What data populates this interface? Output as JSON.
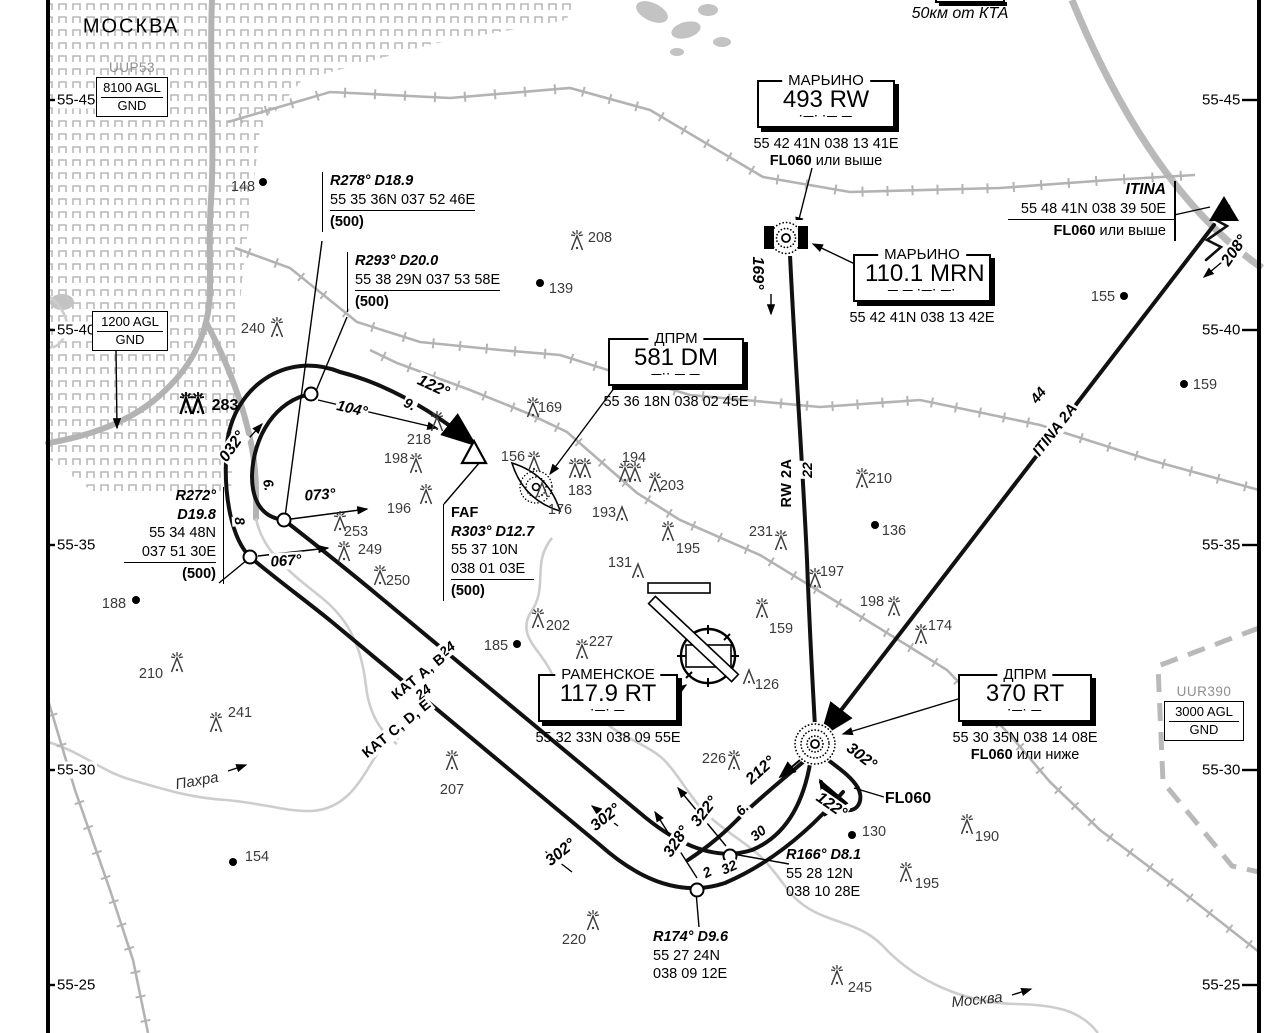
{
  "map": {
    "city_label": "МОСКВА",
    "scale_note": "50км от КТА",
    "lat_labels": [
      {
        "t": "55-45",
        "y": 100
      },
      {
        "t": "55-40",
        "y": 330
      },
      {
        "t": "55-35",
        "y": 545
      },
      {
        "t": "55-30",
        "y": 770
      },
      {
        "t": "55-25",
        "y": 985
      }
    ],
    "airspace_boxes": [
      {
        "id": "uup53",
        "title": "UUP53",
        "rows": [
          "8100 AGL",
          "GND"
        ],
        "x": 96,
        "y": 60,
        "w": 72
      },
      {
        "id": "agl1200",
        "title": "",
        "rows": [
          "1200 AGL",
          "GND"
        ],
        "x": 92,
        "y": 311,
        "w": 76
      },
      {
        "id": "uur390",
        "title": "UUR390",
        "rows": [
          "3000 AGL",
          "GND"
        ],
        "x": 1164,
        "y": 684,
        "w": 80
      }
    ],
    "navaid_boxes": [
      {
        "id": "marino-rw",
        "title": "МАРЬИНО",
        "ident": "493 RW",
        "morse": "·—·   ·— —",
        "x": 757,
        "y": 80,
        "w": 134,
        "coords": "55 42 41N 038 13 41E",
        "note": "FL060 или выше"
      },
      {
        "id": "marino-mrn",
        "title": "МАРЬИНО",
        "ident": "110.1 MRN",
        "morse": "— —   ·—·   —·",
        "x": 853,
        "y": 254,
        "w": 134,
        "coords": "55 42 41N 038 13 42E"
      },
      {
        "id": "dprm-dm",
        "title": "ДПРМ",
        "ident": "581 DM",
        "morse": "—··   — —",
        "x": 608,
        "y": 338,
        "w": 132,
        "coords": "55 36 18N 038 02 45E"
      },
      {
        "id": "ramenskoe",
        "title": "РАМЕНСКОЕ",
        "ident": "117.9 RT",
        "morse": "·—·   —",
        "x": 538,
        "y": 674,
        "w": 136,
        "coords": "55 32 33N 038 09 55E"
      },
      {
        "id": "dprm-rt",
        "title": "ДПРМ",
        "ident": "370 RT",
        "morse": "·—·   —",
        "x": 958,
        "y": 674,
        "w": 130,
        "coords": "55 30 35N 038 14 08E",
        "note": "FL060 или ниже"
      }
    ],
    "itina_box": {
      "title": "ITINA",
      "coords": "55 48 41N 038 39 50E",
      "note": "FL060 или выше",
      "x": 1008,
      "y": 181,
      "w": 166
    },
    "fix_blocks": [
      {
        "id": "r278",
        "bar": "left",
        "x": 322,
        "y": 172,
        "lines": [
          [
            "R278° D18.9",
            "bi"
          ],
          [
            "55 35 36N 037 52 46E",
            "n ul"
          ]
        ],
        "tail": "(500)"
      },
      {
        "id": "r293",
        "bar": "left",
        "x": 347,
        "y": 252,
        "lines": [
          [
            "R293° D20.0",
            "bi"
          ],
          [
            "55 38 29N 037 53 58E",
            "n ul"
          ]
        ],
        "tail": "(500)"
      },
      {
        "id": "r272",
        "bar": "right",
        "x": 124,
        "y": 487,
        "w": 92,
        "lines": [
          [
            "R272°",
            "bi"
          ],
          [
            "D19.8",
            "bi"
          ],
          [
            "55 34 48N",
            "n"
          ],
          [
            "037 51 30E",
            "n ul"
          ]
        ],
        "tail": "(500)"
      },
      {
        "id": "faf",
        "bar": "left",
        "x": 443,
        "y": 504,
        "lines": [
          [
            "FAF",
            "b"
          ],
          [
            "R303° D12.7",
            "bi"
          ],
          [
            "55 37 10N",
            "n"
          ],
          [
            "038 01 03E",
            "n ul"
          ]
        ],
        "tail": "(500)"
      },
      {
        "id": "r166",
        "bar": "none",
        "x": 786,
        "y": 846,
        "lines": [
          [
            "R166° D8.1",
            "bi"
          ],
          [
            "55 28 12N",
            "n"
          ],
          [
            "038 10 28E",
            "n"
          ]
        ]
      },
      {
        "id": "r174",
        "bar": "none",
        "x": 653,
        "y": 928,
        "lines": [
          [
            "R174° D9.6",
            "bi"
          ],
          [
            "55 27 24N",
            "n"
          ],
          [
            "038 09 12E",
            "n"
          ]
        ]
      }
    ],
    "labels": [
      {
        "t": "МОСКВА",
        "x": 131,
        "y": 27,
        "r": 0,
        "c": "city"
      },
      {
        "t": "50км от КТА",
        "x": 960,
        "y": 14,
        "r": 0,
        "c": "note"
      },
      {
        "t": "169°",
        "x": 757,
        "y": 273,
        "r": 90,
        "c": "crs"
      },
      {
        "t": "22",
        "x": 807,
        "y": 470,
        "r": -90,
        "c": "dist"
      },
      {
        "t": "RW 2A",
        "x": 787,
        "y": 483,
        "r": -90,
        "c": "route"
      },
      {
        "t": "44",
        "x": 1038,
        "y": 395,
        "r": -52,
        "c": "dist"
      },
      {
        "t": "ITINA 2A",
        "x": 1055,
        "y": 430,
        "r": -52,
        "c": "routei"
      },
      {
        "t": "208°",
        "x": 1235,
        "y": 251,
        "r": -55,
        "c": "crs"
      },
      {
        "t": "122°",
        "x": 433,
        "y": 387,
        "r": 25,
        "c": "crs"
      },
      {
        "t": "9.",
        "x": 410,
        "y": 404,
        "r": 25,
        "c": "dist"
      },
      {
        "t": "104°",
        "x": 352,
        "y": 409,
        "r": 13,
        "c": "crsi"
      },
      {
        "t": "032°",
        "x": 233,
        "y": 447,
        "r": -55,
        "c": "crs"
      },
      {
        "t": "073°",
        "x": 320,
        "y": 495,
        "r": -4,
        "c": "crsi"
      },
      {
        "t": "067°",
        "x": 286,
        "y": 561,
        "r": -4,
        "c": "crsi"
      },
      {
        "t": "6.",
        "x": 269,
        "y": 485,
        "r": 80,
        "c": "dist"
      },
      {
        "t": "8",
        "x": 240,
        "y": 521,
        "r": 85,
        "c": "dist"
      },
      {
        "t": "24",
        "x": 447,
        "y": 649,
        "r": -39,
        "c": "dist"
      },
      {
        "t": "КАТ А, В",
        "x": 419,
        "y": 677,
        "r": -39,
        "c": "route"
      },
      {
        "t": "24",
        "x": 423,
        "y": 692,
        "r": -39,
        "c": "dist"
      },
      {
        "t": "КАТ С, D, Е",
        "x": 397,
        "y": 729,
        "r": -39,
        "c": "route"
      },
      {
        "t": "302°",
        "x": 606,
        "y": 818,
        "r": -39,
        "c": "crs"
      },
      {
        "t": "302°",
        "x": 561,
        "y": 853,
        "r": -39,
        "c": "crs"
      },
      {
        "t": "302°",
        "x": 861,
        "y": 757,
        "r": 38,
        "c": "crs"
      },
      {
        "t": "122°",
        "x": 831,
        "y": 806,
        "r": 35,
        "c": "crs"
      },
      {
        "t": "212°",
        "x": 761,
        "y": 771,
        "r": -42,
        "c": "crs"
      },
      {
        "t": "FL060",
        "x": 908,
        "y": 799,
        "r": 0,
        "c": "fl"
      },
      {
        "t": "322°",
        "x": 705,
        "y": 812,
        "r": -52,
        "c": "crs"
      },
      {
        "t": "328°",
        "x": 677,
        "y": 842,
        "r": -56,
        "c": "crs"
      },
      {
        "t": "6.",
        "x": 742,
        "y": 809,
        "r": -47,
        "c": "dist"
      },
      {
        "t": "30",
        "x": 758,
        "y": 833,
        "r": -39,
        "c": "dist"
      },
      {
        "t": "2",
        "x": 707,
        "y": 872,
        "r": -28,
        "c": "dist"
      },
      {
        "t": "32",
        "x": 729,
        "y": 867,
        "r": -24,
        "c": "dist"
      },
      {
        "t": "Пахра",
        "x": 197,
        "y": 781,
        "r": -10,
        "c": "riv"
      },
      {
        "t": "Москва",
        "x": 977,
        "y": 1000,
        "r": -6,
        "c": "riv"
      }
    ],
    "obstacles": [
      {
        "v": "148",
        "t": "dot",
        "x": 263,
        "y": 182,
        "lx": 243,
        "ly": 187
      },
      {
        "v": "208",
        "t": "tl",
        "x": 577,
        "y": 250,
        "lx": 600,
        "ly": 238
      },
      {
        "v": "139",
        "t": "dot",
        "x": 540,
        "y": 283,
        "lx": 561,
        "ly": 289
      },
      {
        "v": "155",
        "t": "dot",
        "x": 1124,
        "y": 296,
        "lx": 1103,
        "ly": 297
      },
      {
        "v": "159",
        "t": "dot",
        "x": 1184,
        "y": 384,
        "lx": 1205,
        "ly": 385
      },
      {
        "v": "240",
        "t": "tl",
        "x": 277,
        "y": 337,
        "lx": 253,
        "ly": 329
      },
      {
        "v": "283",
        "t": "gb",
        "x": 192,
        "y": 414,
        "lx": 225,
        "ly": 406
      },
      {
        "v": "218",
        "t": "tl",
        "x": 437,
        "y": 431,
        "lx": 419,
        "ly": 440
      },
      {
        "v": "169",
        "t": "tl",
        "x": 533,
        "y": 417,
        "lx": 550,
        "ly": 408
      },
      {
        "v": "156",
        "t": "tl",
        "x": 534,
        "y": 471,
        "lx": 513,
        "ly": 457
      },
      {
        "v": "176",
        "t": "t",
        "x": 542,
        "y": 497,
        "lx": 560,
        "ly": 510
      },
      {
        "v": "183",
        "t": "g",
        "x": 580,
        "y": 478,
        "lx": 580,
        "ly": 491
      },
      {
        "v": "194",
        "t": "g",
        "x": 630,
        "y": 482,
        "lx": 634,
        "ly": 458
      },
      {
        "v": "193",
        "t": "t",
        "x": 622,
        "y": 521,
        "lx": 604,
        "ly": 513
      },
      {
        "v": "203",
        "t": "tl",
        "x": 655,
        "y": 492,
        "lx": 672,
        "ly": 486
      },
      {
        "v": "198",
        "t": "tl",
        "x": 416,
        "y": 473,
        "lx": 396,
        "ly": 459
      },
      {
        "v": "196",
        "t": "tl",
        "x": 426,
        "y": 504,
        "lx": 399,
        "ly": 509
      },
      {
        "v": "253",
        "t": "tl",
        "x": 340,
        "y": 531,
        "lx": 356,
        "ly": 532
      },
      {
        "v": "249",
        "t": "tl",
        "x": 344,
        "y": 561,
        "lx": 370,
        "ly": 550
      },
      {
        "v": "250",
        "t": "tl",
        "x": 380,
        "y": 585,
        "lx": 398,
        "ly": 581
      },
      {
        "v": "188",
        "t": "dot",
        "x": 136,
        "y": 600,
        "lx": 114,
        "ly": 604
      },
      {
        "v": "210",
        "t": "tl",
        "x": 862,
        "y": 488,
        "lx": 880,
        "ly": 479
      },
      {
        "v": "136",
        "t": "dot",
        "x": 875,
        "y": 525,
        "lx": 894,
        "ly": 531
      },
      {
        "v": "195",
        "t": "tl",
        "x": 668,
        "y": 541,
        "lx": 688,
        "ly": 549
      },
      {
        "v": "231",
        "t": "tl",
        "x": 781,
        "y": 550,
        "lx": 761,
        "ly": 532
      },
      {
        "v": "197",
        "t": "tl",
        "x": 815,
        "y": 588,
        "lx": 832,
        "ly": 572
      },
      {
        "v": "198",
        "t": "tl",
        "x": 894,
        "y": 616,
        "lx": 872,
        "ly": 602
      },
      {
        "v": "174",
        "t": "tl",
        "x": 921,
        "y": 644,
        "lx": 940,
        "ly": 626
      },
      {
        "v": "131",
        "t": "t",
        "x": 638,
        "y": 578,
        "lx": 620,
        "ly": 563
      },
      {
        "v": "202",
        "t": "tl",
        "x": 538,
        "y": 628,
        "lx": 558,
        "ly": 626
      },
      {
        "v": "227",
        "t": "tl",
        "x": 582,
        "y": 659,
        "lx": 601,
        "ly": 642
      },
      {
        "v": "185",
        "t": "dot",
        "x": 517,
        "y": 644,
        "lx": 496,
        "ly": 646
      },
      {
        "v": "159",
        "t": "tl",
        "x": 762,
        "y": 618,
        "lx": 781,
        "ly": 629
      },
      {
        "v": "126",
        "t": "t",
        "x": 749,
        "y": 684,
        "lx": 767,
        "ly": 685
      },
      {
        "v": "210",
        "t": "tl",
        "x": 177,
        "y": 672,
        "lx": 151,
        "ly": 674
      },
      {
        "v": "241",
        "t": "tl",
        "x": 216,
        "y": 732,
        "lx": 240,
        "ly": 713
      },
      {
        "v": "207",
        "t": "tl",
        "x": 452,
        "y": 770,
        "lx": 452,
        "ly": 790
      },
      {
        "v": "226",
        "t": "tl",
        "x": 734,
        "y": 770,
        "lx": 714,
        "ly": 759
      },
      {
        "v": "154",
        "t": "dot",
        "x": 233,
        "y": 862,
        "lx": 257,
        "ly": 857
      },
      {
        "v": "130",
        "t": "dot",
        "x": 852,
        "y": 835,
        "lx": 874,
        "ly": 832
      },
      {
        "v": "190",
        "t": "tl",
        "x": 967,
        "y": 834,
        "lx": 987,
        "ly": 837
      },
      {
        "v": "195",
        "t": "tl",
        "x": 906,
        "y": 882,
        "lx": 927,
        "ly": 884
      },
      {
        "v": "220",
        "t": "tl",
        "x": 593,
        "y": 930,
        "lx": 574,
        "ly": 940
      },
      {
        "v": "245",
        "t": "tl",
        "x": 837,
        "y": 985,
        "lx": 860,
        "ly": 988
      }
    ]
  }
}
